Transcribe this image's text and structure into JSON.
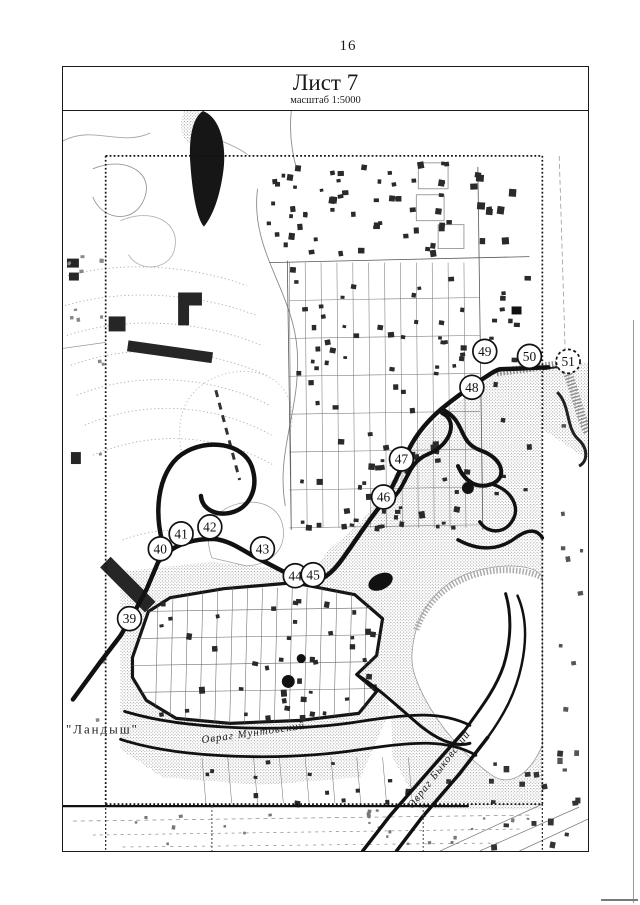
{
  "page": {
    "number": "16"
  },
  "sheet": {
    "title": "Лист 7",
    "scale_note": "масштаб 1:5000"
  },
  "map": {
    "ink_color": "#1a1a1a",
    "stipple_color": "#8f8f8f",
    "contour_color": "#a8a8a8",
    "labels": [
      {
        "id": "settlement-name-landysh",
        "text": "\"Ландыш\"",
        "x": 3,
        "y": 624,
        "rotate": 0,
        "size": 13,
        "italic": false,
        "spacing": 2
      },
      {
        "id": "ravine-muntovsky-label",
        "text": "Овраг Мунтовский",
        "x": 140,
        "y": 634,
        "rotate": -8,
        "size": 11,
        "italic": true,
        "spacing": 1
      },
      {
        "id": "ravine-bykovsky-label",
        "text": "Овраг Быковский",
        "x": 352,
        "y": 700,
        "rotate": -52,
        "size": 11,
        "italic": true,
        "spacing": 1
      }
    ],
    "boundary_points": [
      {
        "n": "39",
        "cx": 67,
        "cy": 509,
        "dashed": false
      },
      {
        "n": "40",
        "cx": 98,
        "cy": 439,
        "dashed": false
      },
      {
        "n": "41",
        "cx": 119,
        "cy": 424,
        "dashed": false
      },
      {
        "n": "42",
        "cx": 148,
        "cy": 417,
        "dashed": false
      },
      {
        "n": "43",
        "cx": 201,
        "cy": 439,
        "dashed": false
      },
      {
        "n": "44",
        "cx": 234,
        "cy": 466,
        "dashed": false
      },
      {
        "n": "45",
        "cx": 252,
        "cy": 465,
        "dashed": false
      },
      {
        "n": "46",
        "cx": 323,
        "cy": 387,
        "dashed": false
      },
      {
        "n": "47",
        "cx": 341,
        "cy": 349,
        "dashed": false
      },
      {
        "n": "48",
        "cx": 412,
        "cy": 277,
        "dashed": false
      },
      {
        "n": "49",
        "cx": 425,
        "cy": 241,
        "dashed": false
      },
      {
        "n": "50",
        "cx": 470,
        "cy": 246,
        "dashed": false
      },
      {
        "n": "51",
        "cx": 509,
        "cy": 251,
        "dashed": true
      }
    ]
  }
}
